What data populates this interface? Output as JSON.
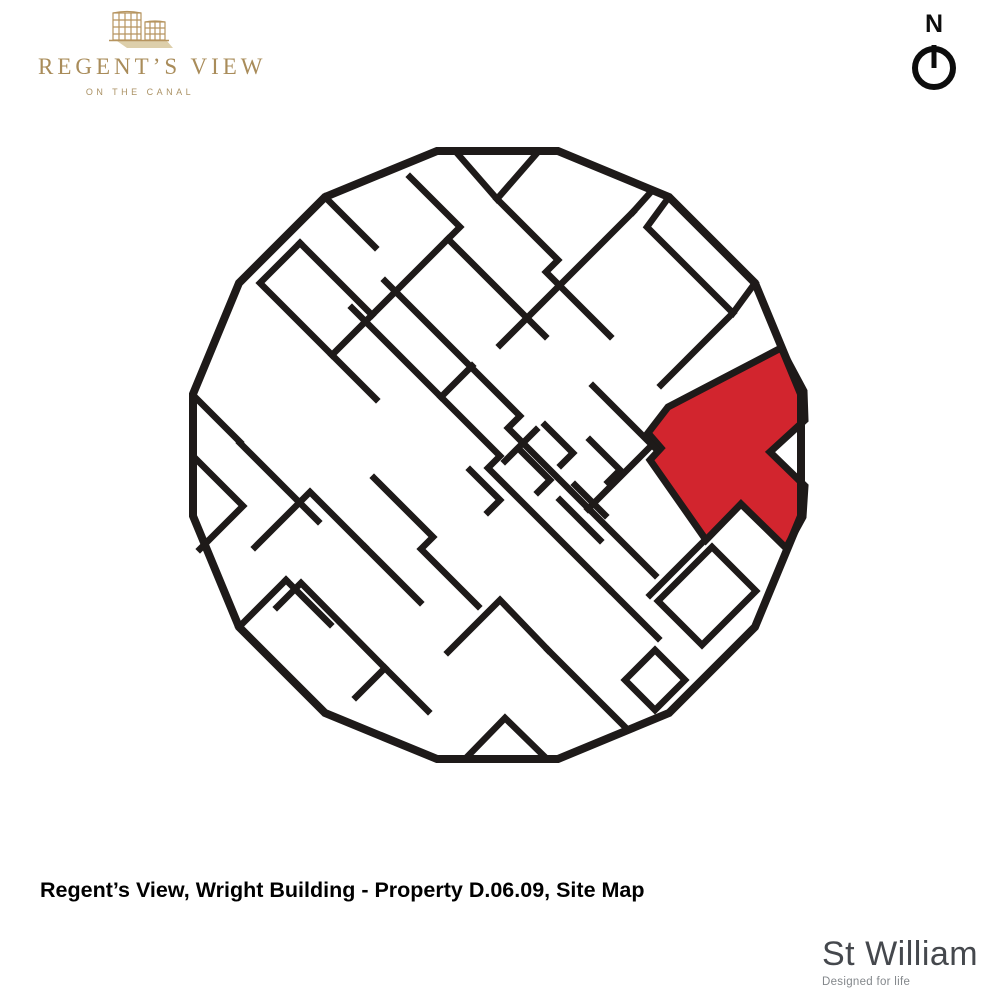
{
  "logo": {
    "title": "REGENT’S VIEW",
    "subtitle": "ON THE CANAL",
    "icon": "gasholder-buildings-icon"
  },
  "compass": {
    "label": "N"
  },
  "caption": {
    "text": "Regent’s View, Wright Building - Property D.06.09, Site Map"
  },
  "brand": {
    "name": "St William",
    "tagline": "Designed for life"
  },
  "colors": {
    "line": "#1e1a19",
    "highlight": "#d2252e",
    "logo_gold": "#b6945f",
    "logo_beige": "#ddcfab",
    "brand_gray": "#45484d"
  },
  "site_map": {
    "highlighted_property": "D.06.09",
    "building": "Wright Building",
    "outline": "437,151 558,151 669,197 755,283 801,394 801,516 755,627 669,713 558,759 437,759 325,713 239,627 193,516 193,394 239,283 325,197",
    "highlight_unit": "781,348 804,391 805,420 770,452 805,486 803,517 786,548 741,504 706,540 650,460 661,448 648,433 668,407",
    "walls": [
      "456,152 497,199 538,152",
      "410,177 460,227 448,239 545,336",
      "448,239 372,315",
      "372,315 300,243",
      "300,243 260,283 332,355 372,315",
      "325,197 375,247",
      "497,199 558,260 546,272 610,336",
      "650,193 633,212",
      "633,212 500,345",
      "669,197 647,227 733,313 755,283",
      "733,313 661,385",
      "656,449 593,386",
      "588,509 648,449",
      "702,543 650,595",
      "385,281 520,416 508,428 655,575",
      "352,308 500,456 488,468 610,590",
      "441,397 472,366",
      "505,461 536,430",
      "470,470 500,500 488,512",
      "520,450 550,480 538,492",
      "545,425 573,453 561,465",
      "590,440 620,470 608,482",
      "575,485 605,515",
      "196,459 243,506 200,549",
      "255,547 310,492 365,547",
      "365,547 420,602",
      "239,627 286,580",
      "286,580 330,624",
      "277,607 301,583 385,668 356,697",
      "385,668 428,711",
      "374,478 433,537 421,549 478,606",
      "658,601 712,547 756,591 702,645 658,601",
      "625,680 655,650 685,680 655,710 625,680",
      "466,758 505,718 546,758",
      "610,590 658,638",
      "240,443 318,521",
      "196,398 240,442",
      "560,500 600,540",
      "332,355 376,399",
      "448,652 500,600 548,650",
      "548,650 625,727"
    ]
  }
}
